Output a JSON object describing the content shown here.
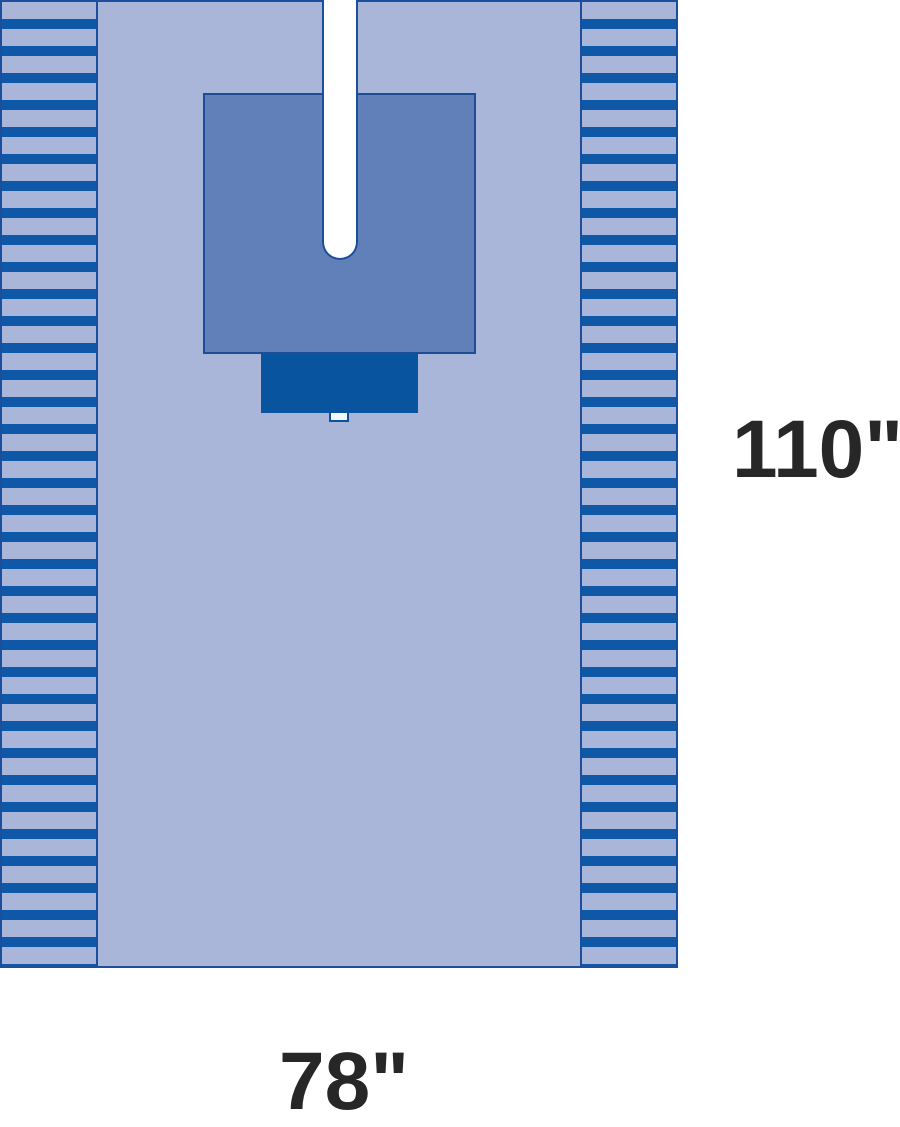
{
  "figure": {
    "type": "product-dimension-diagram",
    "subject": "surgical split drape with fenestration slit, reinforcement panel and fluid pouch",
    "height_label": "110\"",
    "width_label": "78\""
  },
  "components": [
    {
      "name": "drape-body",
      "description": "main drape sheet"
    },
    {
      "name": "left-striped-edge",
      "description": "striped fold/adhesive edge, left"
    },
    {
      "name": "right-striped-edge",
      "description": "striped fold/adhesive edge, right"
    },
    {
      "name": "reinforcement-panel",
      "description": "absorbent reinforcement zone"
    },
    {
      "name": "fenestration-slit",
      "description": "U-shaped split opening from top edge"
    },
    {
      "name": "fluid-pouch",
      "description": "fluid collection pouch"
    },
    {
      "name": "pouch-tab",
      "description": "small drain tab on pouch"
    }
  ],
  "colors": {
    "background": "#ffffff",
    "drape_field": "#aab6d9",
    "stripe_dark": "#0f58a7",
    "border_blue": "#1b4f9b",
    "reinforcement": "#617fb9",
    "reinforcement_border": "#1d4d96",
    "pouch": "#08549e",
    "slit_fill": "#ffffff",
    "tab_fill": "#f2f7fd",
    "label_text": "#272727"
  }
}
